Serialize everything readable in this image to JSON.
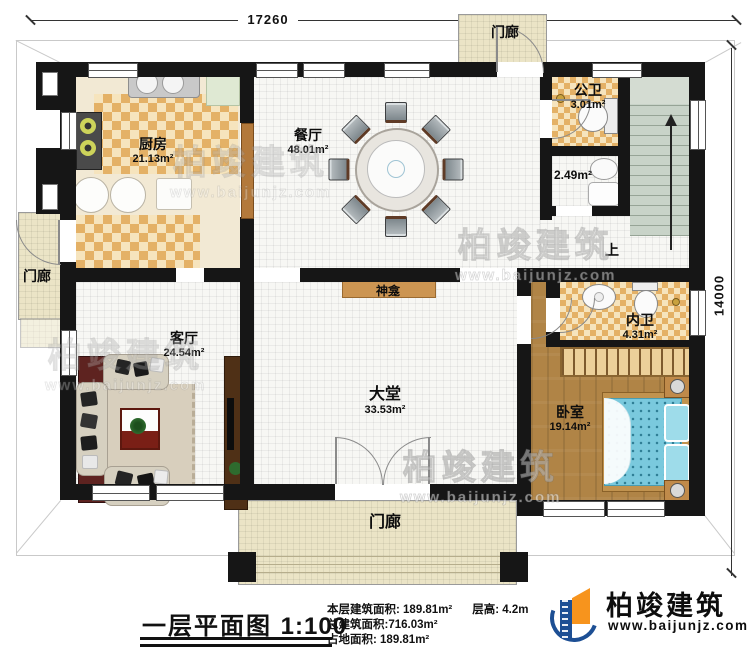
{
  "dimensions": {
    "width_label": "17260",
    "height_label": "14000"
  },
  "rooms": {
    "kitchen": {
      "name": "厨房",
      "area": "21.13m²"
    },
    "dining": {
      "name": "餐厅",
      "area": "48.01m²"
    },
    "public_bath": {
      "name": "公卫",
      "area": "3.01m²"
    },
    "utility": {
      "area": "2.49m²"
    },
    "stairs": {
      "up_label": "上"
    },
    "shrine": {
      "name": "神龛"
    },
    "living": {
      "name": "客厅",
      "area": "24.54m²"
    },
    "hall": {
      "name": "大堂",
      "area": "33.53m²"
    },
    "ensuite": {
      "name": "内卫",
      "area": "4.31m²"
    },
    "bedroom": {
      "name": "卧室",
      "area": "19.14m²"
    },
    "porch_top": {
      "name": "门廊"
    },
    "porch_left": {
      "name": "门廊"
    },
    "porch_bottom": {
      "name": "门廊"
    }
  },
  "title_block": {
    "title": "一层平面图",
    "scale": "1:100",
    "stats": {
      "line1a": "本层建筑面积: 189.81m²",
      "line1b": "层高: 4.2m",
      "line2": "总建筑面积:716.03m²",
      "line3": "占地面积: 189.81m²"
    }
  },
  "brand": {
    "name": "柏竣建筑",
    "url": "www.baijunjz.com"
  },
  "watermark": {
    "text": "柏竣建筑",
    "url": "www.baijunjz.com"
  },
  "colors": {
    "wall": "#161616",
    "checker": "#e4b166",
    "wood": "#b08446",
    "bed": "#7ac9dd",
    "brand_blue": "#1d4f94",
    "brand_orange": "#f7941d"
  }
}
